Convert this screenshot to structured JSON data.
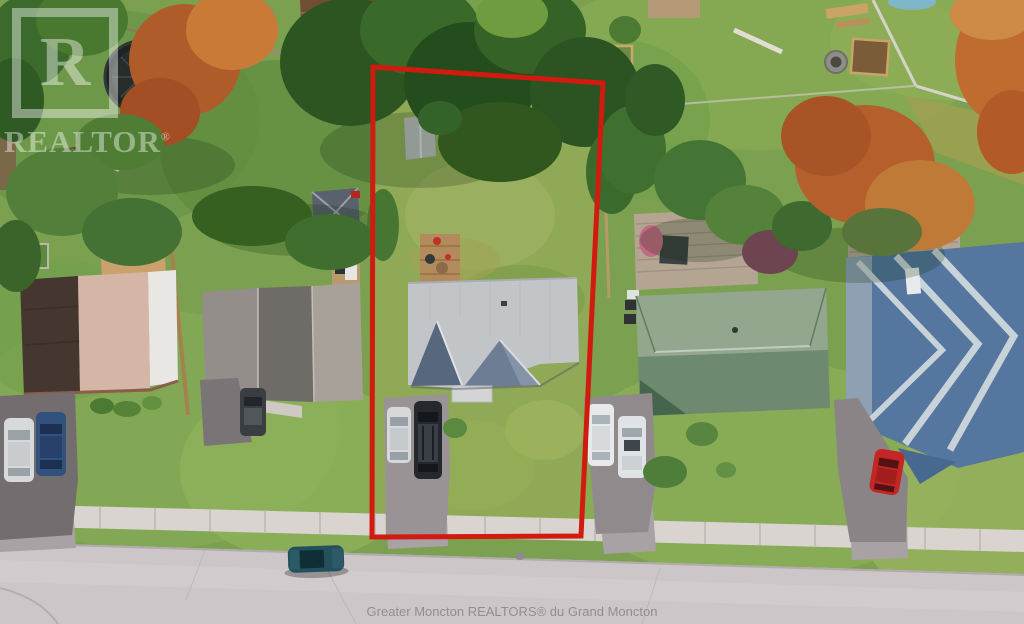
{
  "page": {
    "type": "aerial-real-estate-photo",
    "width": 1024,
    "height": 624
  },
  "watermark": {
    "letter": "R",
    "word": "REALTOR",
    "registered": "®"
  },
  "caption": {
    "text": "Greater Moncton REALTORS® du Grand Moncton"
  },
  "colors": {
    "boundary_red": "#d11a10",
    "grass_base": "#7ba050",
    "road_gray": "#ccc6c8",
    "sidewalk_gray": "#d9d4d0",
    "target_roof_gray": "#c2c5c8",
    "green_roof": "#6d8a70",
    "blue_roof": "#54769f",
    "caption_gray": "#8f8f93",
    "watermark_white": "rgba(255,255,255,0.42)"
  },
  "scene": {
    "description": "Overhead drone view of a residential lot outlined in red, flanked by neighbouring houses, backyards, a sidewalk and a curving street at the bottom.",
    "objects": [
      "red property boundary",
      "target house with gray gabled roof",
      "backyard shed",
      "wood deck with patio items",
      "lot driveway with silver car and black SUV",
      "left neighbour house with brown, pink and white roof sections",
      "left neighbour driveway with silver and blue cars",
      "gray-roof neighbour house with slate hip-roof shed",
      "green hip-roof neighbour house with rear deck",
      "blue chevron-ridge roof neighbour house",
      "red car in driveway",
      "two white cars in shared driveway",
      "teal car parked on street",
      "trampoline",
      "children's play set with slide",
      "raised garden beds",
      "stone fire pit",
      "picnic bench",
      "brown backyard cabin",
      "backyard fences",
      "sidewalk with expansion joints",
      "street with curb"
    ]
  }
}
